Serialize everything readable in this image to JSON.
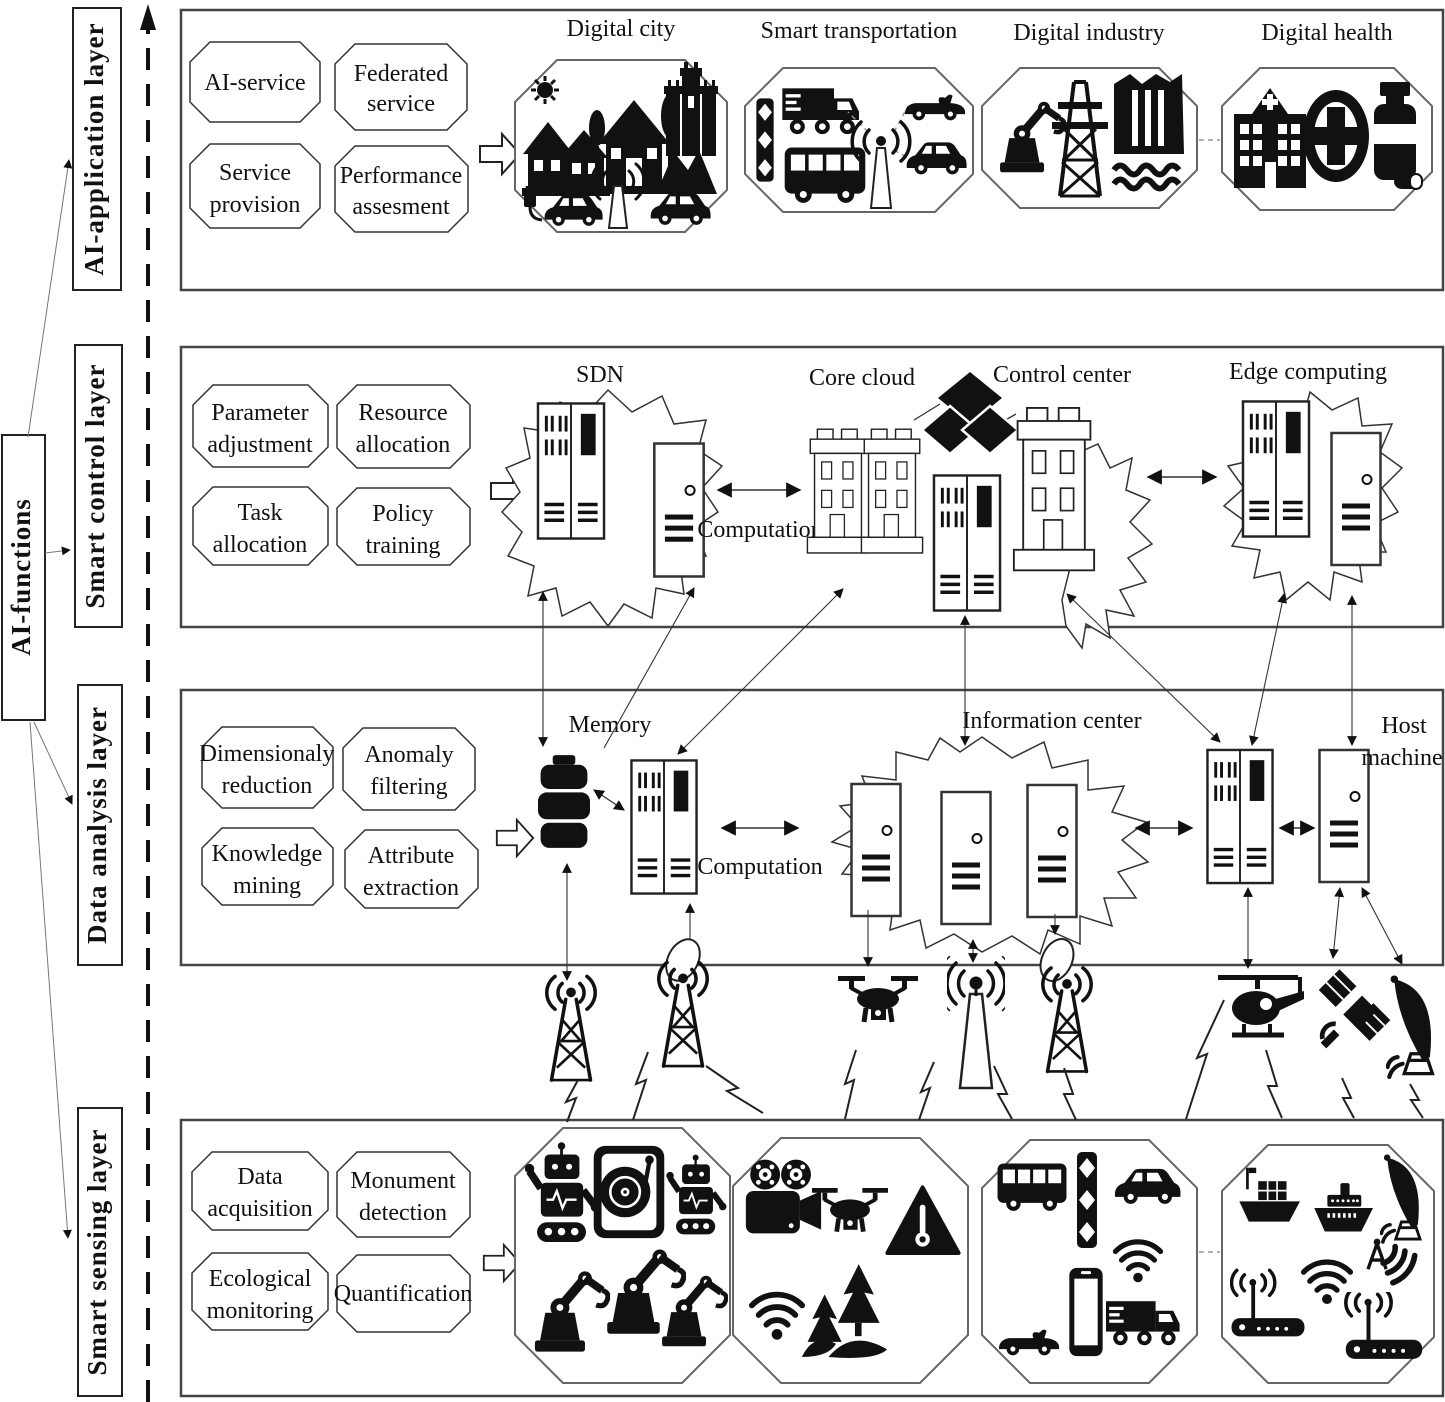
{
  "side_label": "AI-functions",
  "application": {
    "label": "AI-application layer",
    "functions": [
      {
        "l1": "AI-service",
        "l2": ""
      },
      {
        "l1": "Federated",
        "l2": "service"
      },
      {
        "l1": "Service",
        "l2": "provision"
      },
      {
        "l1": "Performance",
        "l2": "assesment"
      }
    ],
    "groups": [
      {
        "title": "Digital city",
        "icons": [
          "sun",
          "houses",
          "house-with-trees",
          "castle",
          "electric-car",
          "antenna",
          "car"
        ]
      },
      {
        "title": "Smart transportation",
        "icons": [
          "traffic-light",
          "truck",
          "bus",
          "antenna",
          "convertible",
          "car"
        ]
      },
      {
        "title": "Digital industry",
        "icons": [
          "robot-arm",
          "power-pylon",
          "dam"
        ]
      },
      {
        "title": "Digital health",
        "icons": [
          "hospital",
          "medical-cross",
          "pill-bottle"
        ]
      }
    ]
  },
  "control": {
    "label": "Smart control layer",
    "functions": [
      {
        "l1": "Parameter",
        "l2": "adjustment"
      },
      {
        "l1": "Resource",
        "l2": "allocation"
      },
      {
        "l1": "Task",
        "l2": "allocation"
      },
      {
        "l1": "Policy",
        "l2": "training"
      }
    ],
    "nodes": {
      "sdn": "SDN",
      "core_cloud": "Core cloud",
      "control_center": "Control center",
      "edge_computing": "Edge computing"
    },
    "computation": "Computation"
  },
  "analysis": {
    "label": "Data analysis layer",
    "functions": [
      {
        "l1": "Dimensionaly",
        "l2": "reduction"
      },
      {
        "l1": "Anomaly",
        "l2": "filtering"
      },
      {
        "l1": "Knowledge",
        "l2": "mining"
      },
      {
        "l1": "Attribute",
        "l2": "extraction"
      }
    ],
    "nodes": {
      "memory": "Memory",
      "information_center": "Information center",
      "host_l1": "Host",
      "host_l2": "machine"
    },
    "computation": "Computation"
  },
  "sensing": {
    "label": "Smart sensing layer",
    "functions": [
      {
        "l1": "Data",
        "l2": "acquisition"
      },
      {
        "l1": "Monument",
        "l2": "detection"
      },
      {
        "l1": "Ecological",
        "l2": "monitoring"
      },
      {
        "l1": "Quantification",
        "l2": ""
      }
    ],
    "groups": [
      {
        "icons": [
          "robot",
          "turntable",
          "robot",
          "robot-arm",
          "robot-arm",
          "robot-arm"
        ]
      },
      {
        "icons": [
          "movie-camera",
          "drone",
          "warning-thermometer",
          "wifi",
          "forest"
        ]
      },
      {
        "icons": [
          "bus",
          "traffic-light",
          "car",
          "convertible",
          "smartphone",
          "wifi-truck"
        ]
      },
      {
        "icons": [
          "cargo-ship",
          "cruise-ship",
          "satellite-dish",
          "router",
          "wifi",
          "radar",
          "router"
        ]
      }
    ]
  },
  "band_icons": [
    "cell-tower",
    "cell-tower",
    "balloon",
    "drone",
    "beacon-antenna",
    "balloon",
    "cell-tower",
    "helicopter",
    "satellite",
    "satellite-dish"
  ],
  "colors": {
    "ink": "#111",
    "box_stroke": "#444",
    "background": "#ffffff"
  }
}
